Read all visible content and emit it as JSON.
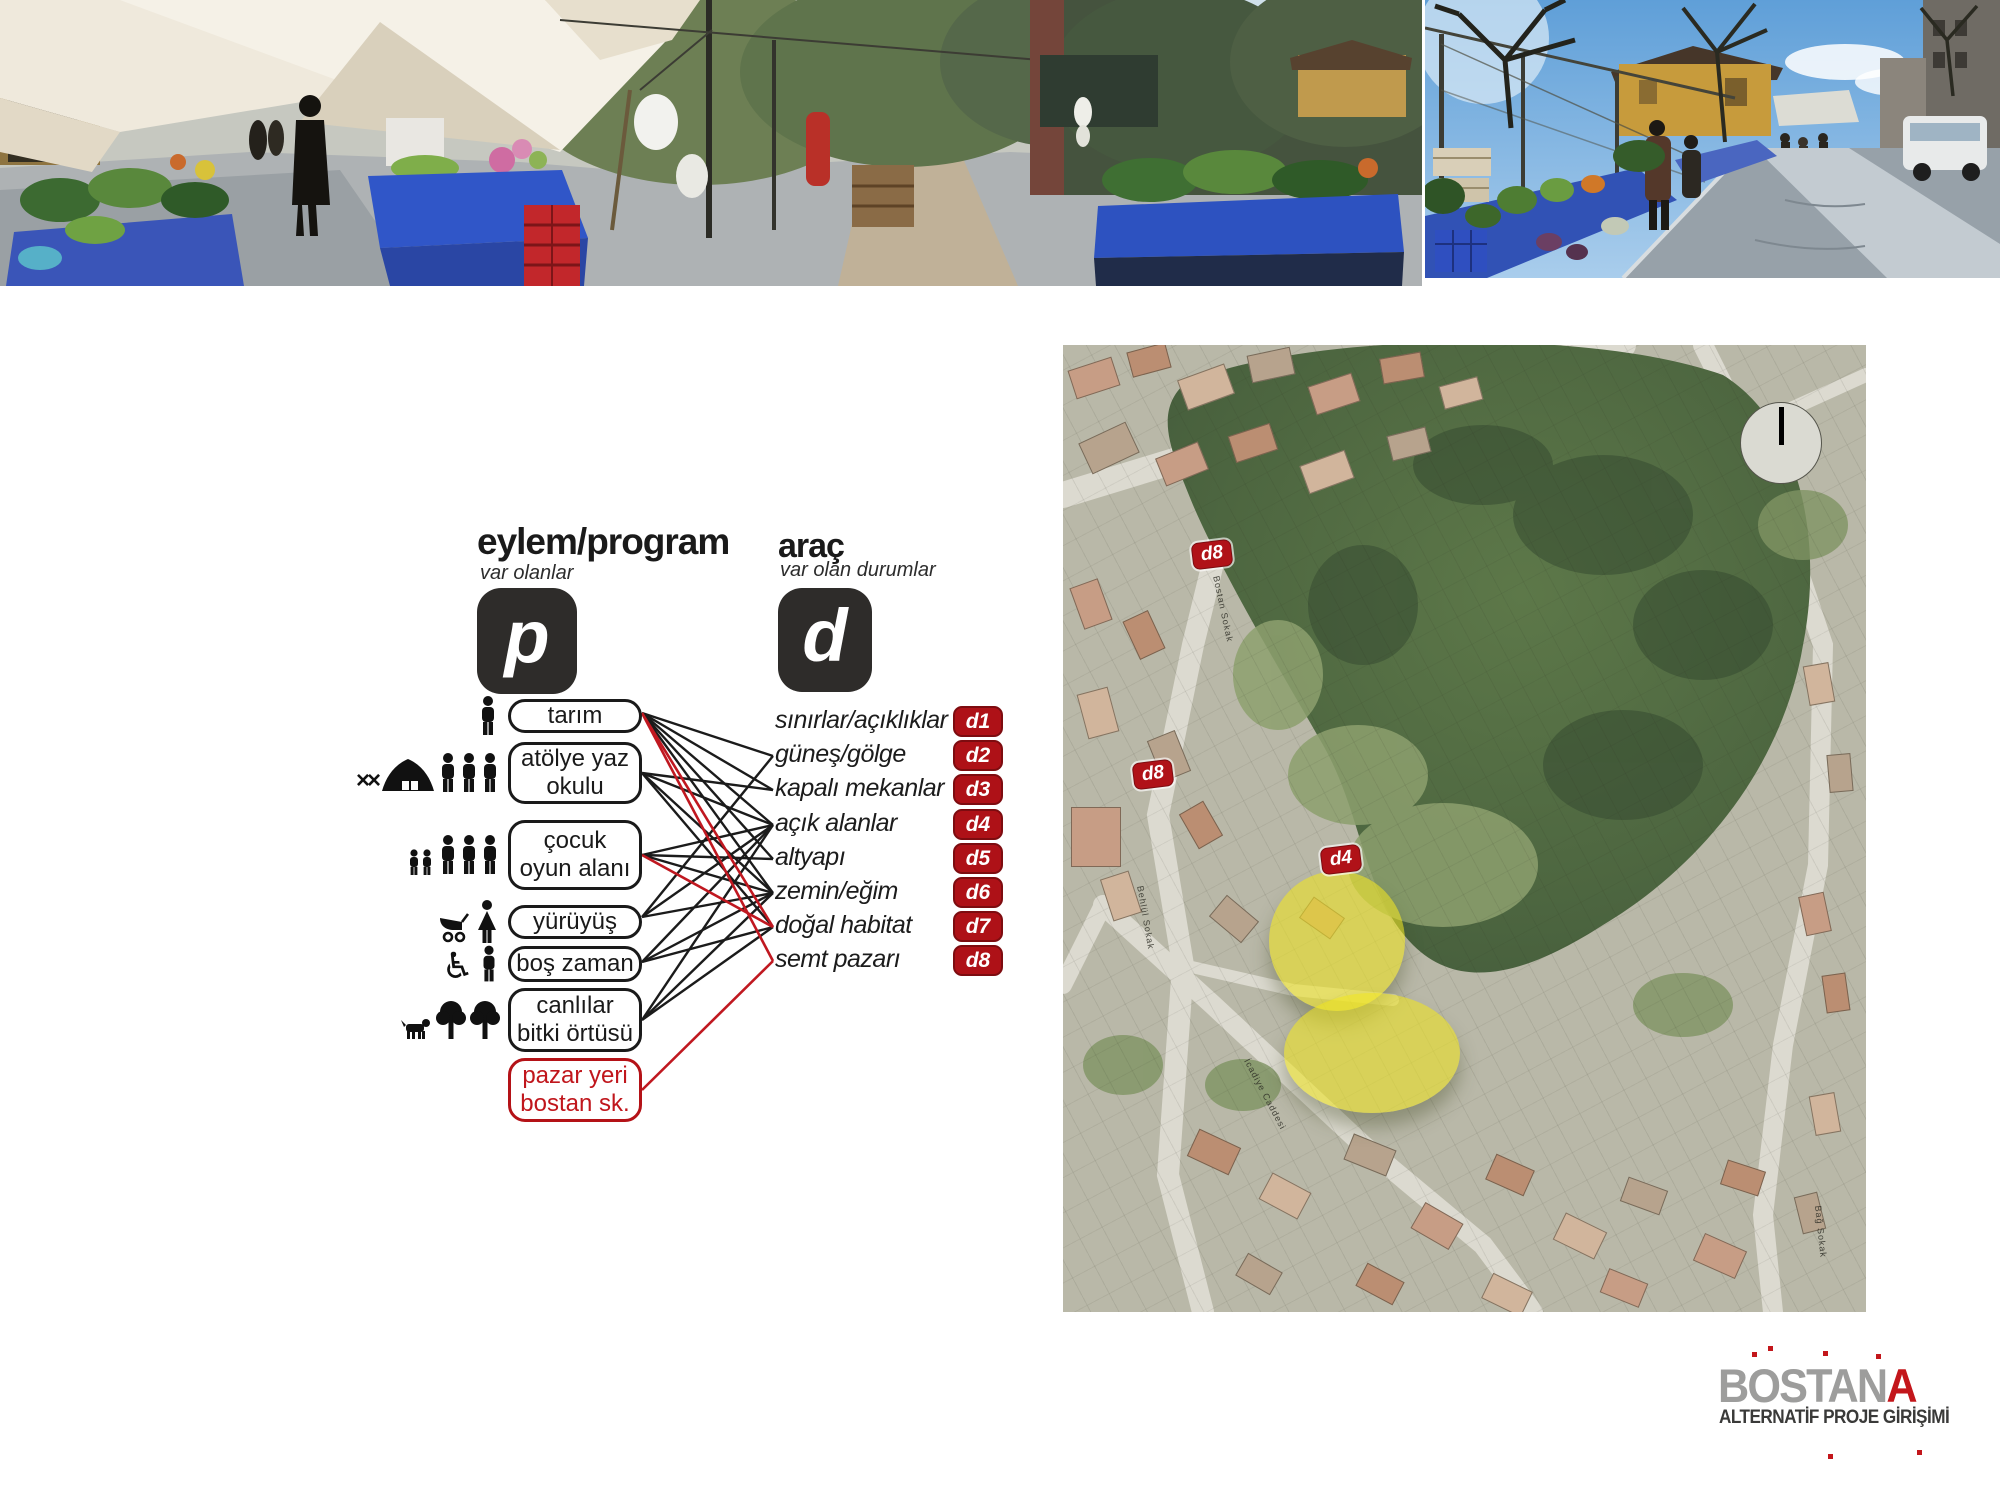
{
  "colors": {
    "accent_red": "#ae1117",
    "line_red": "#c01820",
    "line_black": "#1b1b1b",
    "key_black": "#2e2c2a",
    "logo_gray": "#9d9d9c",
    "logo_red": "#c3161b",
    "highlight_yellow": "rgba(237,228,33,0.58)"
  },
  "diagram": {
    "p": {
      "title": "eylem/program",
      "subtitle": "var olanlar",
      "symbol": "p",
      "items": [
        {
          "label": "tarım",
          "icons": [
            "person"
          ]
        },
        {
          "label": "atölye yaz okulu",
          "icons": [
            "cross-tools",
            "tent",
            "people-3"
          ]
        },
        {
          "label": "çocuk oyun alanı",
          "icons": [
            "children-2",
            "people-3"
          ]
        },
        {
          "label": "yürüyüş",
          "icons": [
            "stroller",
            "woman"
          ]
        },
        {
          "label": "boş zaman",
          "icons": [
            "wheelchair",
            "man"
          ]
        },
        {
          "label": "canlılar bitki örtüsü",
          "icons": [
            "dog",
            "tree",
            "tree"
          ]
        },
        {
          "label": "pazar yeri bostan sk.",
          "icons": [],
          "highlight": true
        }
      ]
    },
    "d": {
      "title": "araç",
      "subtitle": "var olan durumlar",
      "symbol": "d",
      "items": [
        {
          "label": "sınırlar/açıklıklar",
          "code": "d1"
        },
        {
          "label": "güneş/gölge",
          "code": "d2"
        },
        {
          "label": "kapalı mekanlar",
          "code": "d3"
        },
        {
          "label": "açık alanlar",
          "code": "d4"
        },
        {
          "label": "altyapı",
          "code": "d5"
        },
        {
          "label": "zemin/eğim",
          "code": "d6"
        },
        {
          "label": "doğal habitat",
          "code": "d7"
        },
        {
          "label": "semt pazarı",
          "code": "d8"
        }
      ]
    },
    "edges": {
      "black": [
        [
          0,
          1
        ],
        [
          0,
          2
        ],
        [
          0,
          3
        ],
        [
          0,
          4
        ],
        [
          0,
          5
        ],
        [
          1,
          2
        ],
        [
          1,
          3
        ],
        [
          1,
          5
        ],
        [
          1,
          6
        ],
        [
          2,
          3
        ],
        [
          2,
          4
        ],
        [
          2,
          5
        ],
        [
          3,
          1
        ],
        [
          3,
          3
        ],
        [
          3,
          5
        ],
        [
          4,
          3
        ],
        [
          4,
          5
        ],
        [
          4,
          6
        ],
        [
          5,
          3
        ],
        [
          5,
          5
        ],
        [
          5,
          6
        ]
      ],
      "red": [
        [
          0,
          6
        ],
        [
          0,
          7
        ],
        [
          2,
          6
        ],
        [
          6,
          7
        ]
      ]
    }
  },
  "map": {
    "markers": [
      {
        "code": "d8",
        "x": 151,
        "y": 212
      },
      {
        "code": "d8",
        "x": 92,
        "y": 432
      },
      {
        "code": "d4",
        "x": 280,
        "y": 517
      }
    ],
    "highlights": [
      {
        "cx": 274,
        "cy": 596,
        "rx": 68,
        "ry": 70
      },
      {
        "cx": 309,
        "cy": 708,
        "rx": 88,
        "ry": 60
      }
    ],
    "street_labels": [
      {
        "text": "Bostan Sokak",
        "x": 158,
        "y": 230,
        "rot": 78
      },
      {
        "text": "Behlül Sokak",
        "x": 82,
        "y": 540,
        "rot": 80
      },
      {
        "text": "İcadiye Caddesi",
        "x": 188,
        "y": 712,
        "rot": 62
      },
      {
        "text": "Bağ Sokak",
        "x": 760,
        "y": 860,
        "rot": 84
      }
    ],
    "north_indicator": "north-up"
  },
  "logo": {
    "word_gray": "BOSTAN",
    "word_red": "A",
    "subtitle": "ALTERNATİF PROJE GİRİŞİMİ"
  }
}
